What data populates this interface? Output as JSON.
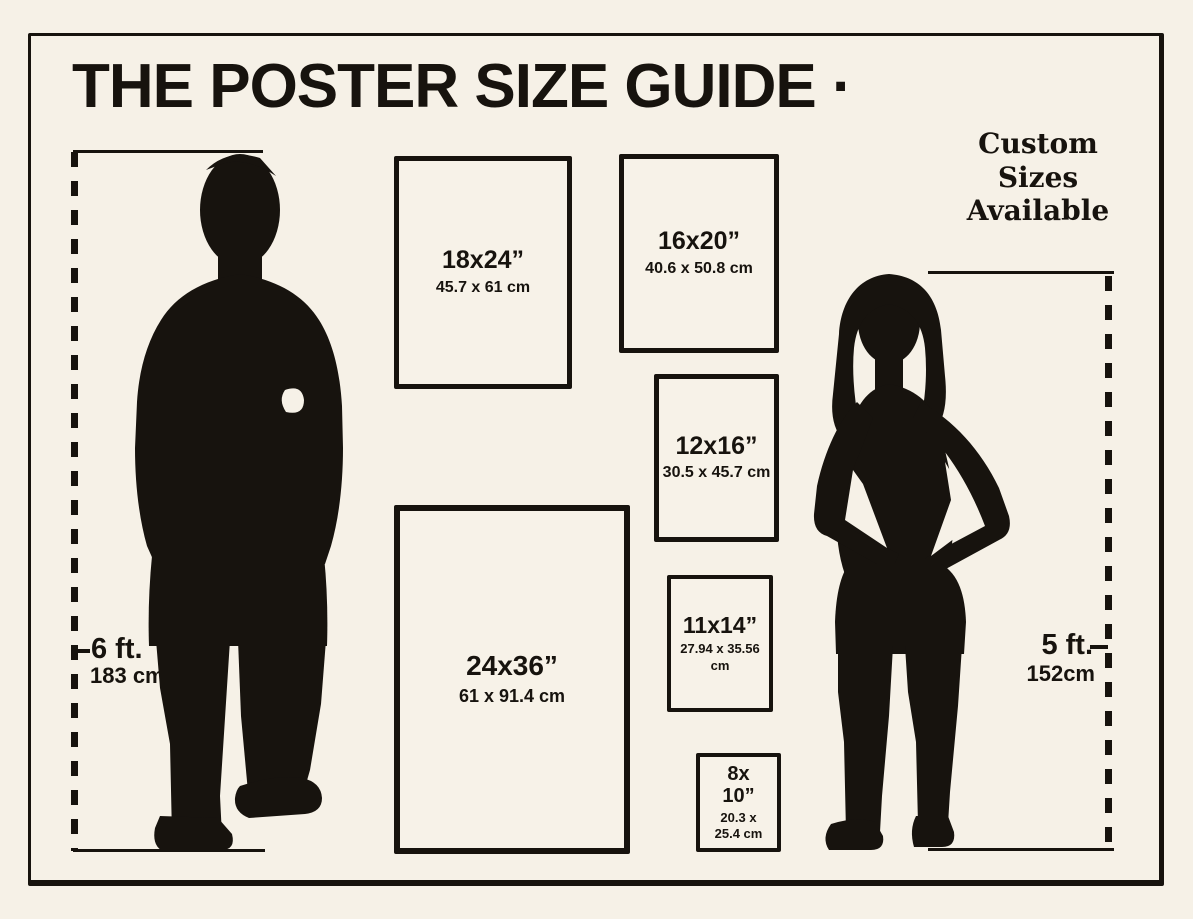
{
  "page": {
    "title": "THE POSTER SIZE GUIDE ·",
    "note": "Custom\nSizes\nAvailable"
  },
  "colors": {
    "background": "#f6f1e7",
    "ink": "#17130e",
    "poster_fill": "#f7f2e8"
  },
  "figures": {
    "man": {
      "icon": "man-silhouette",
      "height_imperial": "6 ft.",
      "height_metric": "183 cm"
    },
    "woman": {
      "icon": "woman-silhouette",
      "height_imperial": "5 ft.",
      "height_metric": "152cm"
    }
  },
  "posters": [
    {
      "id": "18x24",
      "size": "18x24”",
      "metric": "45.7 x 61 cm"
    },
    {
      "id": "16x20",
      "size": "16x20”",
      "metric": "40.6 x 50.8 cm"
    },
    {
      "id": "12x16",
      "size": "12x16”",
      "metric": "30.5 x 45.7 cm"
    },
    {
      "id": "11x14",
      "size": "11x14”",
      "metric": "27.94 x 35.56 cm"
    },
    {
      "id": "24x36",
      "size": "24x36”",
      "metric": "61 x 91.4 cm"
    },
    {
      "id": "8x10",
      "size": "8x\n10”",
      "metric": "20.3 x\n25.4 cm"
    }
  ]
}
